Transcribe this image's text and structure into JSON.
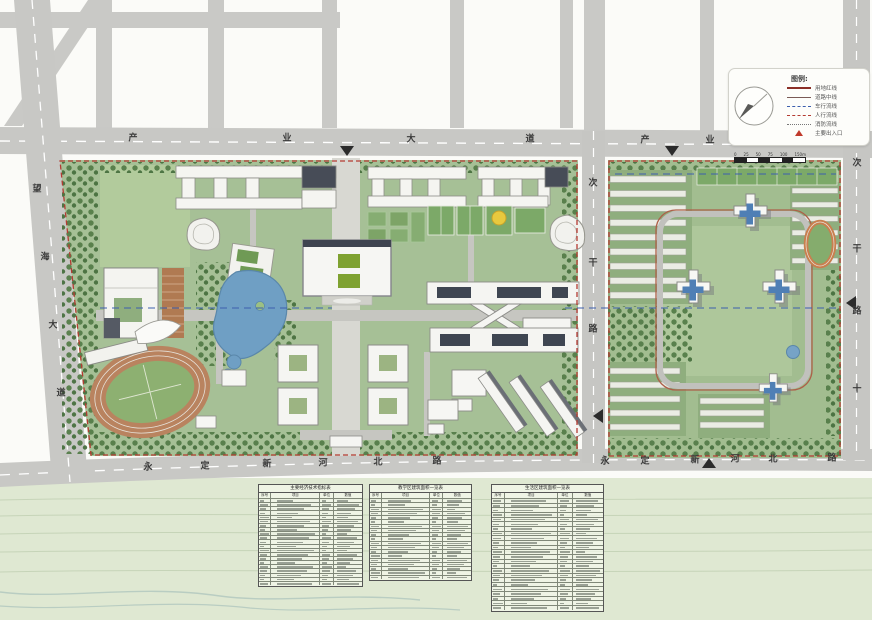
{
  "roads": {
    "top_avenue_west": [
      "产",
      "业",
      "大",
      "道"
    ],
    "top_avenue_east": [
      "产",
      "业",
      "大",
      "道"
    ],
    "bottom_road_west": [
      "永",
      "定",
      "新",
      "河",
      "北",
      "路"
    ],
    "bottom_road_east": [
      "永",
      "定",
      "新",
      "河",
      "北",
      "路"
    ],
    "left_avenue": [
      "望",
      "海",
      "大",
      "道"
    ],
    "middle_road": [
      "次",
      "干",
      "路"
    ],
    "right_road": [
      "次",
      "干",
      "路",
      "十"
    ]
  },
  "legend": {
    "title": "图例:",
    "items": [
      {
        "label": "用地红线",
        "style": "solid-red"
      },
      {
        "label": "道路中线",
        "style": "solid-thin"
      },
      {
        "label": "车行流线",
        "style": "dashed-blue"
      },
      {
        "label": "人行流线",
        "style": "dashed-red"
      },
      {
        "label": "消防流线",
        "style": "dotted-gray"
      },
      {
        "label": "主要出入口",
        "style": "triangle-red"
      }
    ]
  },
  "scalebar": {
    "labels": [
      "0",
      "25",
      "50",
      "75",
      "100",
      "150m"
    ]
  },
  "tables": [
    {
      "title": "主要经济技术指标表",
      "header": [
        "序号",
        "项目",
        "单位",
        "数值"
      ],
      "row_count": 21
    },
    {
      "title": "教学区建筑面积一览表",
      "header": [
        "序号",
        "项目",
        "单位",
        "数值"
      ],
      "row_count": 19
    },
    {
      "title": "生活区建筑面积一览表",
      "header": [
        "序号",
        "项目",
        "单位",
        "数值"
      ],
      "row_count": 24
    }
  ]
}
